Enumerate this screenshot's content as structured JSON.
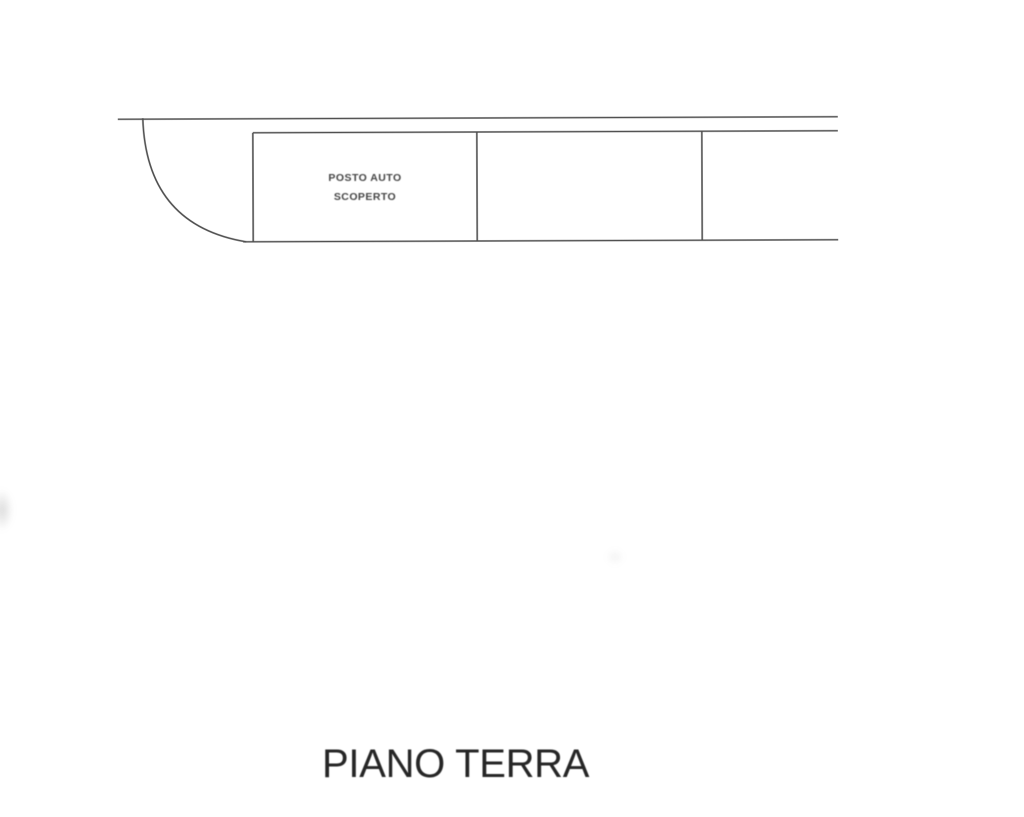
{
  "colors": {
    "paper": "#ffffff",
    "line": "#4f4f4f",
    "smalltext": "#454545",
    "title": "#262626"
  },
  "plan": {
    "parking_label": {
      "line1": "POSTO AUTO",
      "line2": "SCOPERTO"
    },
    "floor_title": "PIANO TERRA"
  }
}
